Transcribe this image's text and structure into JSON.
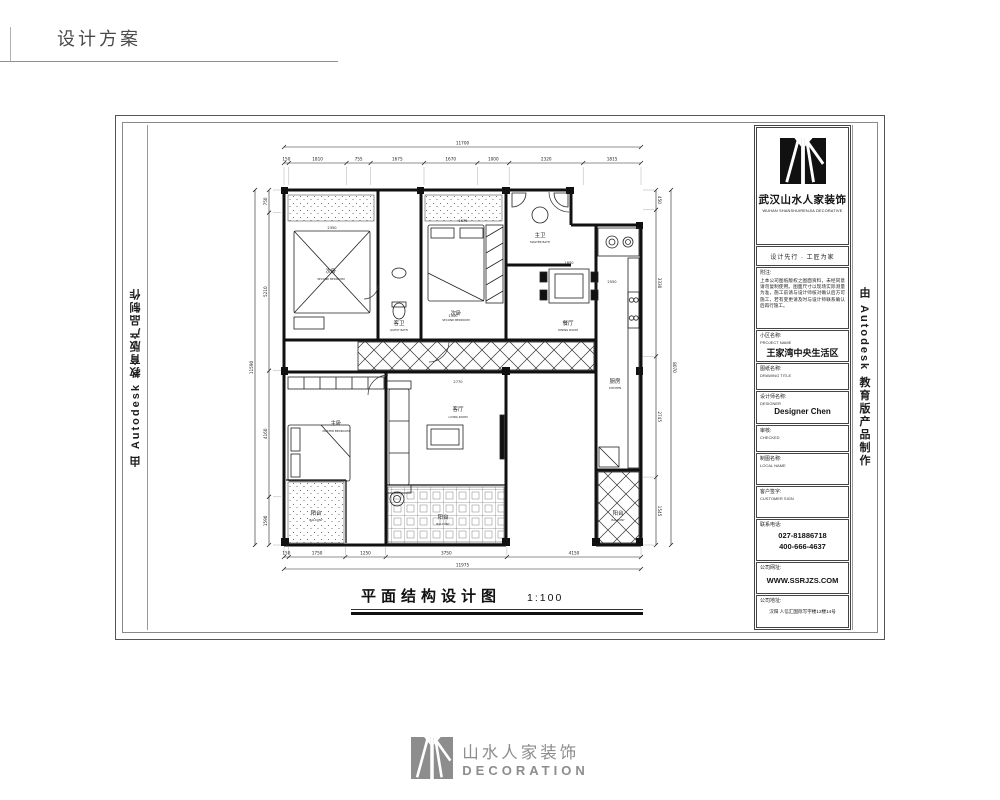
{
  "header": {
    "title": "设计方案"
  },
  "watermarks": {
    "left": "由 Autodesk 教育版产品制作",
    "right": "由 Autodesk 教育版产品制作"
  },
  "titleblock": {
    "company_cn": "武汉山水人家装饰",
    "company_en": "WUHAN SHANSHUIRENJIA DECORATIVE",
    "slogan": "设计先行 · 工匠为家",
    "notes_label": "附注:",
    "notes_text": "上本公司图纸版权之图面资料，未经同意请勿复制使用。图面尺寸以现场实际测量为准，施工前请与设计师核对确认后方可施工，若有变更请及时与设计师联系确认后再行施工。",
    "project": {
      "label": "小区名称:",
      "sub": "PROJECT NAME",
      "value": "王家湾中央生活区"
    },
    "drawing": {
      "label": "图纸名称:",
      "sub": "DRAWING TITLE",
      "value": ""
    },
    "designer": {
      "label": "设计师名称:",
      "sub": "DESIGNER",
      "value": "Designer Chen"
    },
    "check": {
      "label": "审核:",
      "sub": "CHECKED",
      "value": ""
    },
    "draftsman": {
      "label": "制图名称:",
      "sub": "LOCAL NAME",
      "value": ""
    },
    "sign": {
      "label": "客户签字:",
      "sub": "CUSTOMER SIGN",
      "value": ""
    },
    "tel": {
      "label": "联系电话:",
      "line1": "027-81886718",
      "line2": "400-666-4637"
    },
    "web": {
      "label": "公司网址:",
      "value": "WWW.SSRJZS.COM"
    },
    "addr": {
      "label": "公司地址:",
      "value": "汉阳 人信汇国际写字楼12楼14号"
    }
  },
  "plan": {
    "caption": "平面结构设计图",
    "scale": "1:100",
    "rooms": [
      {
        "cn": "次卧",
        "en": "SECOND BEDROOM"
      },
      {
        "cn": "客卫",
        "en": "GUEST BATH"
      },
      {
        "cn": "次卧",
        "en": "SECOND BEDROOM"
      },
      {
        "cn": "主卫",
        "en": "MASTER BATH"
      },
      {
        "cn": "厨房",
        "en": "KITCHEN"
      },
      {
        "cn": "餐厅",
        "en": "DINING ROOM"
      },
      {
        "cn": "主卧",
        "en": "MASTER BEDROOM"
      },
      {
        "cn": "客厅",
        "en": "LIVING ROOM"
      },
      {
        "cn": "阳台",
        "en": "BALCONY"
      },
      {
        "cn": "阳台",
        "en": "BALCONY"
      },
      {
        "cn": "阳台",
        "en": "BALCONY"
      }
    ],
    "dims": {
      "top_total": "11700",
      "top": [
        "150",
        "1810",
        "755",
        "1675",
        "1670",
        "1000",
        "2320",
        "1815"
      ],
      "bottom_total": "11975",
      "bottom": [
        "150",
        "1750",
        "1250",
        "3750",
        "4150"
      ],
      "left_total": "11590",
      "left": [
        "750",
        "5210",
        "4160",
        "1590"
      ],
      "right_total": "8070",
      "right": [
        "450",
        "3330",
        "2745",
        "1545"
      ],
      "inner": [
        "2350",
        "1675",
        "1500",
        "1850",
        "2550",
        "2770"
      ]
    }
  },
  "footer": {
    "logo_cn": "山水人家装饰",
    "logo_en": "DECORATION"
  }
}
